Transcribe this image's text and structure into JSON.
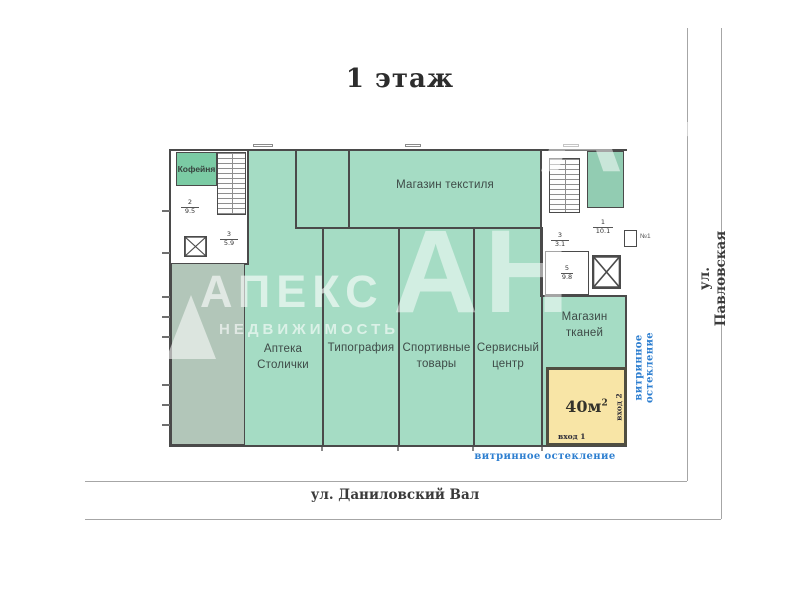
{
  "title": "1 этаж",
  "streets": {
    "bottom": "ул. Даниловский Вал",
    "right": "ул. Павловская"
  },
  "glazing": {
    "bottom": "витринное остекление",
    "right": "витринное остекление"
  },
  "units": {
    "kofeinya": {
      "label": "Кофейня"
    },
    "textile_store": {
      "label": "Магазин текстиля"
    },
    "pharmacy": {
      "label": "Аптека Столички"
    },
    "print_shop": {
      "label": "Типография"
    },
    "sporting_goods": {
      "label": "Спортивные товары"
    },
    "service_center": {
      "label": "Сервисный центр"
    },
    "fabric_store": {
      "label": "Магазин тканей"
    },
    "vacant_unit": {
      "area_label": "40м",
      "area_sup": "2",
      "entrance_1": "вход 1",
      "entrance_2": "вход 2"
    }
  },
  "rooms": [
    {
      "num": "2",
      "area": "9.5"
    },
    {
      "num": "3",
      "area": "5.9"
    },
    {
      "num": "1",
      "area": "10.1"
    },
    {
      "num": "3",
      "area": "3.1"
    },
    {
      "num": "5",
      "area": "9.8"
    }
  ],
  "porch": {
    "label": "№1"
  },
  "watermark": {
    "brand": "АПЕКС",
    "subtitle": "НЕДВИЖИМОСТЬ",
    "initials": "АН",
    "initials_top": "АН"
  },
  "colors": {
    "unit_green": "#a5dcc4",
    "dark_green_room": "#92ccb2",
    "corridor_green": "#b2c6b9",
    "kofeinya_green": "#7bcba4",
    "vacant_yellow": "#f8e5a6",
    "glazing_blue": "#2e7fd0",
    "wall": "#4a4a4a"
  }
}
